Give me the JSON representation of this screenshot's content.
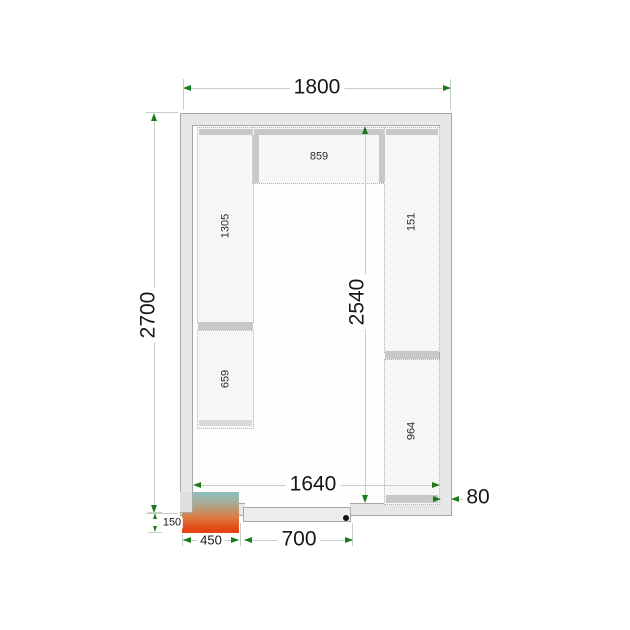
{
  "title": "Cold room floor plan drawing",
  "dims": {
    "width": "1800",
    "depth": "2700",
    "interior_depth": "2540",
    "interior_width": "1640",
    "wall_thickness": "80",
    "unit_offset": "150",
    "unit_width": "450",
    "door_width": "700"
  },
  "shelves": {
    "top": "859",
    "left_upper": "1305",
    "left_lower": "659",
    "right_upper": "151",
    "right_lower": "964"
  },
  "colors": {
    "dimension_line": "#c3d2c3",
    "dimension_arrow": "#1e7a1e",
    "wall_fill": "#e7e7e7",
    "shelf_fill": "#f6f6f6",
    "shelf_bar": "#c8c8c8",
    "unit_gradient_top": "#8cc2c0",
    "unit_gradient_bottom": "#e5430f",
    "door_handle": "#111111"
  }
}
